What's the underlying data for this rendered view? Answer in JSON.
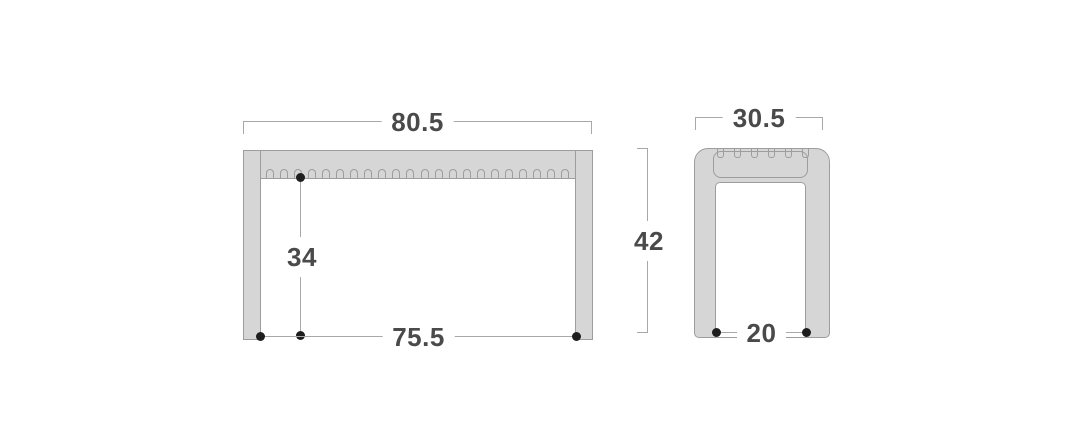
{
  "drawing": {
    "type": "furniture-dimension-diagram",
    "views": {
      "front": {
        "label_overall_width": "80.5",
        "label_height_under_top": "34",
        "label_inner_width": "75.5",
        "slat_count": 22
      },
      "side": {
        "label_overall_depth": "30.5",
        "label_overall_height": "42",
        "label_inner_depth": "20",
        "slat_count": 6
      }
    },
    "colors": {
      "bg": "#ffffff",
      "fill": "#d6d6d6",
      "stroke": "#9d9d9d",
      "dim": "#a8a8a8",
      "text": "#4a4a4a",
      "dot": "#1e1e1e"
    }
  }
}
